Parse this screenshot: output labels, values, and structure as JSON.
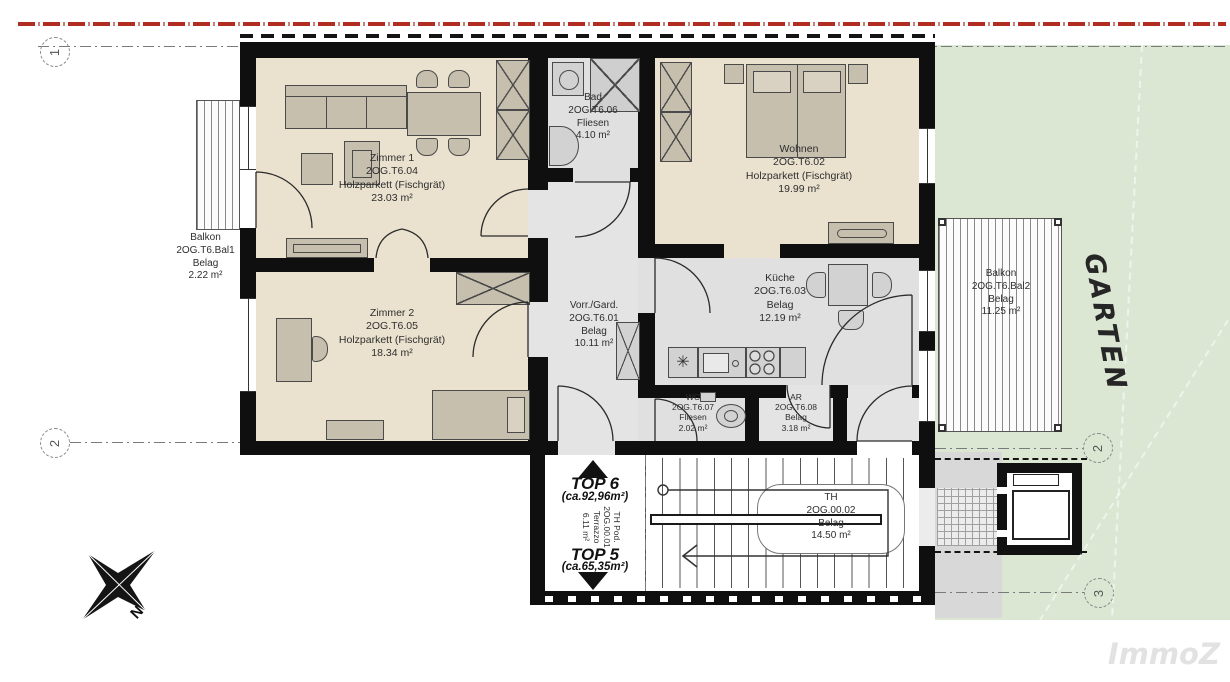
{
  "plan": {
    "watermark": "ImmoZ",
    "garden_label": "GARTEN",
    "compass_north": "N",
    "units": {
      "top6_name": "TOP 6",
      "top6_area": "(ca.92,96m²)",
      "top5_name": "TOP 5",
      "top5_area": "(ca.65,35m²)"
    },
    "markers": {
      "left_top": "1",
      "left_bottom": "2",
      "right_top": "2",
      "right_bottom": "3"
    },
    "symbols": {
      "kitchen_star": "✳"
    },
    "rooms": [
      {
        "name": "Zimmer 1",
        "code": "2OG.T6.04",
        "floor": "Holzparkett (Fischgrät)",
        "area": "23.03 m²"
      },
      {
        "name": "Zimmer 2",
        "code": "2OG.T6.05",
        "floor": "Holzparkett (Fischgrät)",
        "area": "18.34 m²"
      },
      {
        "name": "Bad",
        "code": "2OG.T6.06",
        "floor": "Fliesen",
        "area": "4.10 m²"
      },
      {
        "name": "Vorr./Gard.",
        "code": "2OG.T6.01",
        "floor": "Belag",
        "area": "10.11 m²"
      },
      {
        "name": "Wohnen",
        "code": "2OG.T6.02",
        "floor": "Holzparkett (Fischgrät)",
        "area": "19.99 m²"
      },
      {
        "name": "Küche",
        "code": "2OG.T6.03",
        "floor": "Belag",
        "area": "12.19 m²"
      },
      {
        "name": "WC",
        "code": "2OG.T6.07",
        "floor": "Fliesen",
        "area": "2.02 m²"
      },
      {
        "name": "AR",
        "code": "2OG.T6.08",
        "floor": "Belag",
        "area": "3.18 m²"
      },
      {
        "name": "Balkon",
        "code": "2OG.T6.Bal1",
        "floor": "Belag",
        "area": "2.22 m²"
      },
      {
        "name": "Balkon",
        "code": "2OG.T6.Bal2",
        "floor": "Belag",
        "area": "11.25 m²"
      },
      {
        "name": "TH Pod.",
        "code": "2OG.00.01",
        "floor": "Terrazzo",
        "area": "6.11 m²"
      },
      {
        "name": "TH",
        "code": "2OG.00.02",
        "floor": "Belag",
        "area": "14.50 m²"
      }
    ],
    "colors": {
      "wall": "#0f0f0f",
      "wood_floor": "#eae2cf",
      "tile_floor": "#e2e2e2",
      "garden": "#dce7d3",
      "boundary_red": "#b12d22"
    }
  }
}
